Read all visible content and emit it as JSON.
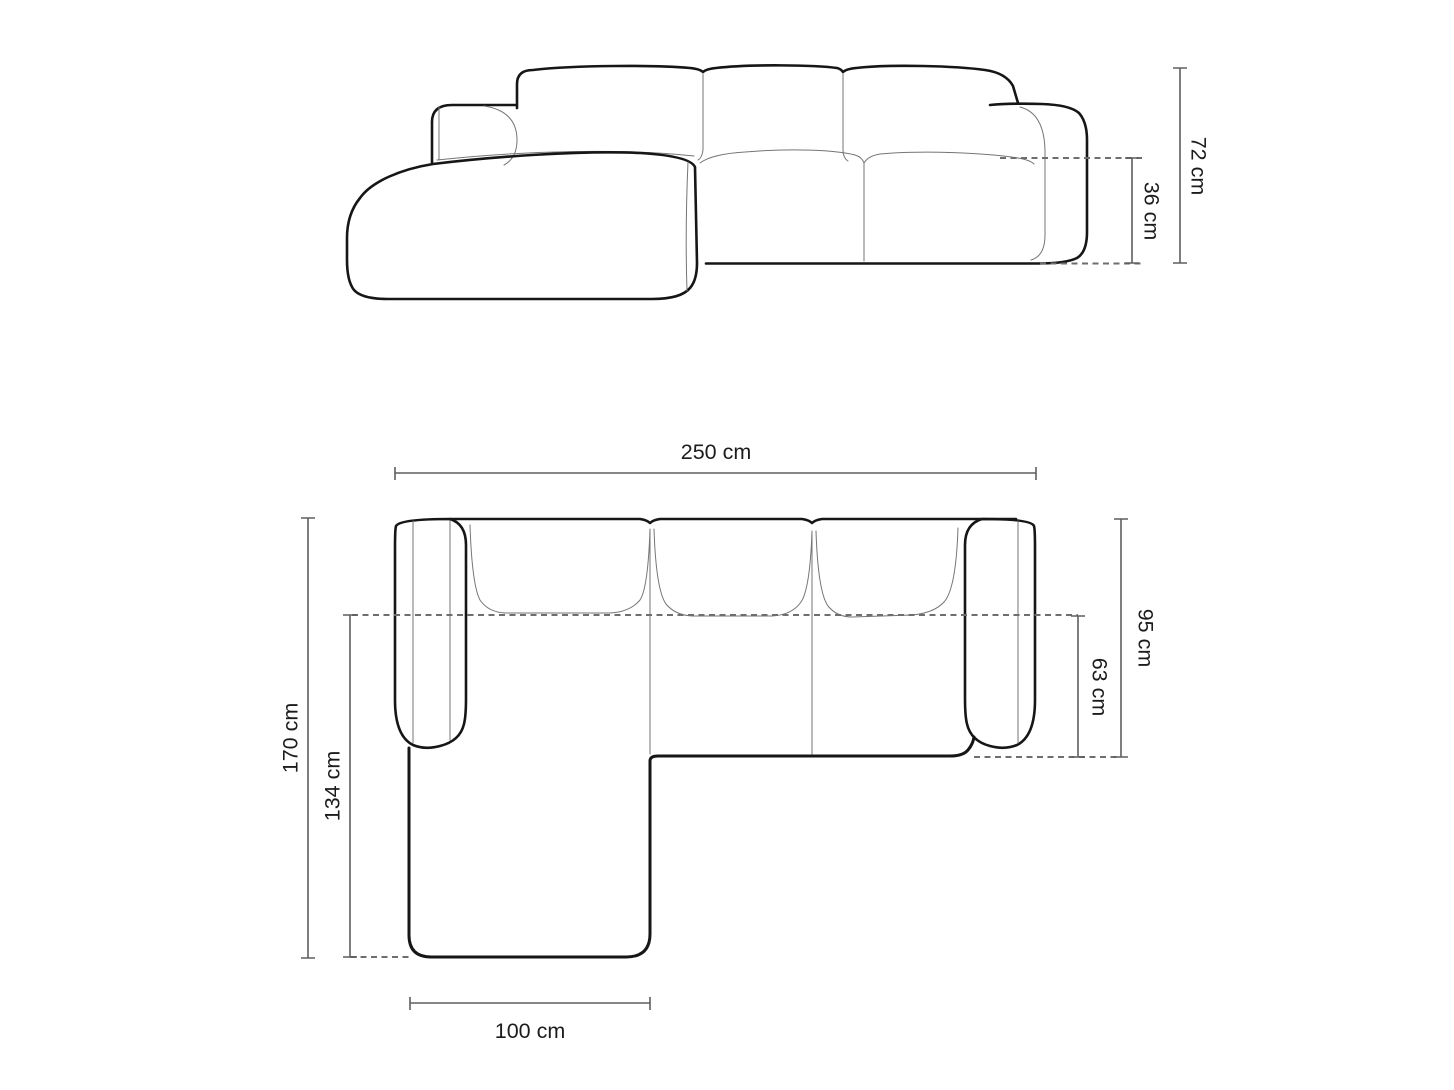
{
  "diagram": {
    "type": "corner-sofa dimension drawing",
    "views": {
      "side_view": {
        "name": "side elevation",
        "dims": {
          "total_height": "72 cm",
          "seat_height": "36 cm"
        }
      },
      "top_view": {
        "name": "top plan",
        "dims": {
          "total_width": "250 cm",
          "total_depth": "170 cm",
          "chaise_depth": "134 cm",
          "body_depth": "95 cm",
          "seat_depth": "63 cm",
          "chaise_width": "100 cm"
        }
      }
    },
    "colors": {
      "background": "#ffffff",
      "outline": "#161616",
      "seam_line": "#757575",
      "dimension_line": "#5f5f5f",
      "label_text": "#1c1c1c"
    }
  }
}
